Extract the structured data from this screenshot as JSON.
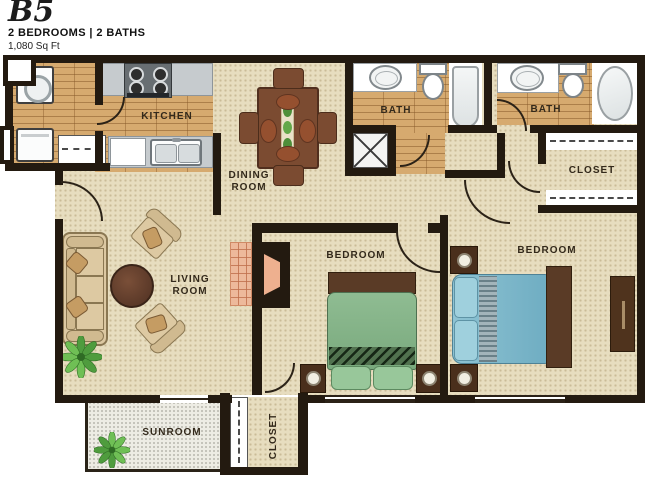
{
  "header": {
    "plan_code": "B5",
    "specs": "2 BEDROOMS | 2 BATHS",
    "area": "1,080 Sq Ft"
  },
  "rooms": {
    "kitchen": "KITCHEN",
    "dining": "DINING ROOM",
    "living": "LIVING ROOM",
    "bath_1": "BATH",
    "bath_2": "BATH",
    "bedroom_1": "BEDROOM",
    "bedroom_2": "BEDROOM",
    "closet_upper": "CLOSET",
    "closet_lower": "CLOSET",
    "sunroom": "SUNROOM"
  },
  "palette": {
    "wall": "#231a10",
    "carpet": "#e7ddbf",
    "wood": "#d6aa6f",
    "counter": "#c6cbce",
    "bed_green": "#86b489",
    "bed_blue": "#75b2c6",
    "furniture_brown": "#7b4b31",
    "hearth_salmon": "#edb99b",
    "plant_green": "#4f9c3e",
    "sunroom_floor": "#edece4"
  },
  "furniture": [
    "washer",
    "dryer",
    "pantry-shelves",
    "stove",
    "kitchen-sink",
    "dishwasher",
    "dining-table",
    "dining-chairs",
    "sofa",
    "armchairs",
    "coffee-table",
    "tv-unit",
    "hearth",
    "plants",
    "bed-green",
    "bed-blue",
    "nightstands",
    "lamps",
    "dresser",
    "toilets",
    "bathtub",
    "garden-tub",
    "vanity-sinks",
    "utility-closet"
  ]
}
